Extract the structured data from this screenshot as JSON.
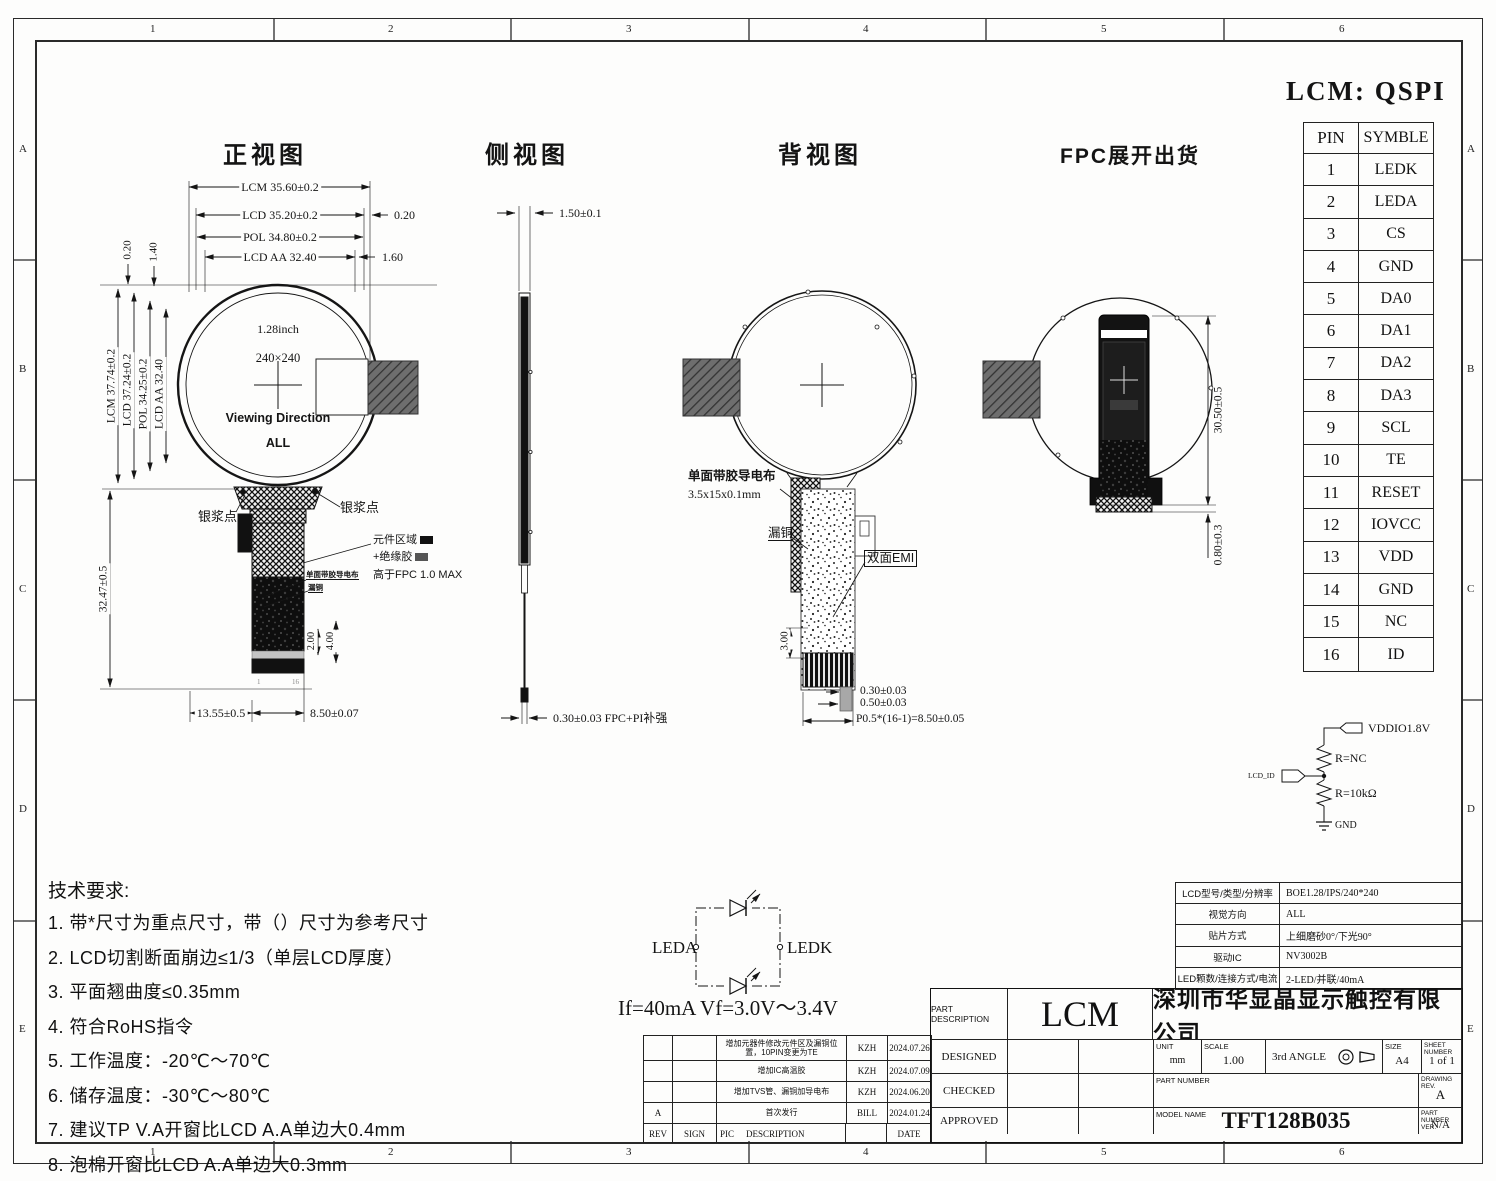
{
  "sheet": {
    "border": {
      "cols": [
        "1",
        "2",
        "3",
        "4",
        "5",
        "6"
      ],
      "rows": [
        "A",
        "B",
        "C",
        "D",
        "E"
      ]
    },
    "title": "LCM: QSPI"
  },
  "front": {
    "title": "正视图",
    "dim_lcm_w": "LCM 35.60±0.2",
    "dim_lcd_w": "LCD 35.20±0.2",
    "dim_020r": "0.20",
    "dim_pol_w": "POL 34.80±0.2",
    "dim_aa_w": "LCD AA 32.40",
    "dim_160": "1.60",
    "dim_020l": "0.20",
    "dim_140": "1.40",
    "dim_lcm_h": "LCM 37.74±0.2",
    "dim_lcd_h": "LCD 37.24±0.2",
    "dim_pol_h": "POL 34.25±0.2",
    "dim_aa_h": "LCD AA 32.40",
    "dim_tail_h": "32.47±0.5",
    "dim_200": "2.00",
    "dim_400": "4.00",
    "dim_1355": "13.55±0.5",
    "dim_850": "8.50±0.07",
    "size_inch": "1.28inch",
    "resolution": "240×240",
    "viewing": "Viewing Direction",
    "viewing_all": "ALL",
    "silver_left": "银浆点",
    "silver_right": "银浆点",
    "comp_area": "元件区域",
    "insulation": "+绝缘胶",
    "above_fpc": "高于FPC 1.0 MAX",
    "cond_cloth": "单面带胶导电布",
    "leak_copper": "漏铜",
    "pin_first": "1",
    "pin_last": "16"
  },
  "side": {
    "title": "侧视图",
    "dim_top": "1.50±0.1",
    "dim_bottom": "0.30±0.03 FPC+PI补强"
  },
  "back": {
    "title": "背视图",
    "cond_cloth": "单面带胶导电布",
    "cond_cloth_size": "3.5x15x0.1mm",
    "leak_copper": "漏铜",
    "emi": "双面EMI",
    "dim_300": "3.00",
    "dim_030": "0.30±0.03",
    "dim_050": "0.50±0.03",
    "dim_pitch": "P0.5*(16-1)=8.50±0.05"
  },
  "fpc": {
    "title": "FPC展开出货",
    "dim_height": "30.50±0.5",
    "dim_080": "0.80±0.3"
  },
  "pin_table": {
    "col_pin": "PIN",
    "col_symbol": "SYMBLE",
    "rows": [
      [
        "1",
        "LEDK"
      ],
      [
        "2",
        "LEDA"
      ],
      [
        "3",
        "CS"
      ],
      [
        "4",
        "GND"
      ],
      [
        "5",
        "DA0"
      ],
      [
        "6",
        "DA1"
      ],
      [
        "7",
        "DA2"
      ],
      [
        "8",
        "DA3"
      ],
      [
        "9",
        "SCL"
      ],
      [
        "10",
        "TE"
      ],
      [
        "11",
        "RESET"
      ],
      [
        "12",
        "IOVCC"
      ],
      [
        "13",
        "VDD"
      ],
      [
        "14",
        "GND"
      ],
      [
        "15",
        "NC"
      ],
      [
        "16",
        "ID"
      ]
    ]
  },
  "id_circuit": {
    "vddio": "VDDIO1.8V",
    "r_top": "R=NC",
    "r_bottom": "R=10kΩ",
    "gnd": "GND",
    "lcd_id": "LCD_ID"
  },
  "tech": {
    "title": "技术要求:",
    "items": [
      "1.  带*尺寸为重点尺寸，带（）尺寸为参考尺寸",
      "2.  LCD切割断面崩边≤1/3（单层LCD厚度）",
      "3.  平面翘曲度≤0.35mm",
      "4.  符合RoHS指令",
      "5.  工作温度：-20℃～70℃",
      "6.  储存温度：-30℃～80℃",
      "7.  建议TP V.A开窗比LCD A.A单边大0.4mm",
      "8.  泡棉开窗比LCD A.A单边大0.3mm"
    ]
  },
  "led_circuit": {
    "leda": "LEDA",
    "ledk": "LEDK",
    "spec": "If=40mA   Vf=3.0V～3.4V"
  },
  "revisions": {
    "headers": {
      "rev": "REV",
      "sign": "SIGN",
      "pic": "PIC",
      "desc": "DESCRIPTION",
      "date": "DATE"
    },
    "rows": [
      {
        "rev": "",
        "desc": "增加元器件修改元件区及漏铜位置，10PIN变更为TE",
        "sign": "KZH",
        "date": "2024.07.26"
      },
      {
        "rev": "",
        "desc": "增加IC高温胶",
        "sign": "KZH",
        "date": "2024.07.09"
      },
      {
        "rev": "",
        "desc": "增加TVS管、漏铜加导电布",
        "sign": "KZH",
        "date": "2024.06.20"
      },
      {
        "rev": "A",
        "desc": "首次发行",
        "sign": "BILL",
        "date": "2024.01.24"
      }
    ]
  },
  "spec_table": {
    "rows": [
      [
        "LCD型号/类型/分辨率",
        "BOE1.28/IPS/240*240"
      ],
      [
        "视觉方向",
        "ALL"
      ],
      [
        "贴片方式",
        "上细磨砂0°/下光90°"
      ],
      [
        "驱动IC",
        "NV3002B"
      ],
      [
        "LED颗数/连接方式/电流",
        "2-LED/并联/40mA"
      ]
    ]
  },
  "title_block": {
    "part_desc_label": "PART DESCRIPTION",
    "part_desc": "LCM",
    "company": "深圳市华显晶显示触控有限公司",
    "designed": "DESIGNED",
    "checked": "CHECKED",
    "approved": "APPROVED",
    "unit_label": "UNIT",
    "unit": "mm",
    "scale_label": "SCALE",
    "scale": "1.00",
    "angle": "3rd ANGLE",
    "size_label": "SIZE",
    "size": "A4",
    "sheet_label": "SHEET NUMBER",
    "sheet": "1 of 1",
    "part_number_label": "PART NUMBER",
    "drawing_rev_label": "DRAWING REV.",
    "drawing_rev": "A",
    "model_label": "MODEL NAME",
    "model": "TFT128B035",
    "part_ver_label": "PART NUMBER VER.",
    "part_ver": "N/A"
  }
}
